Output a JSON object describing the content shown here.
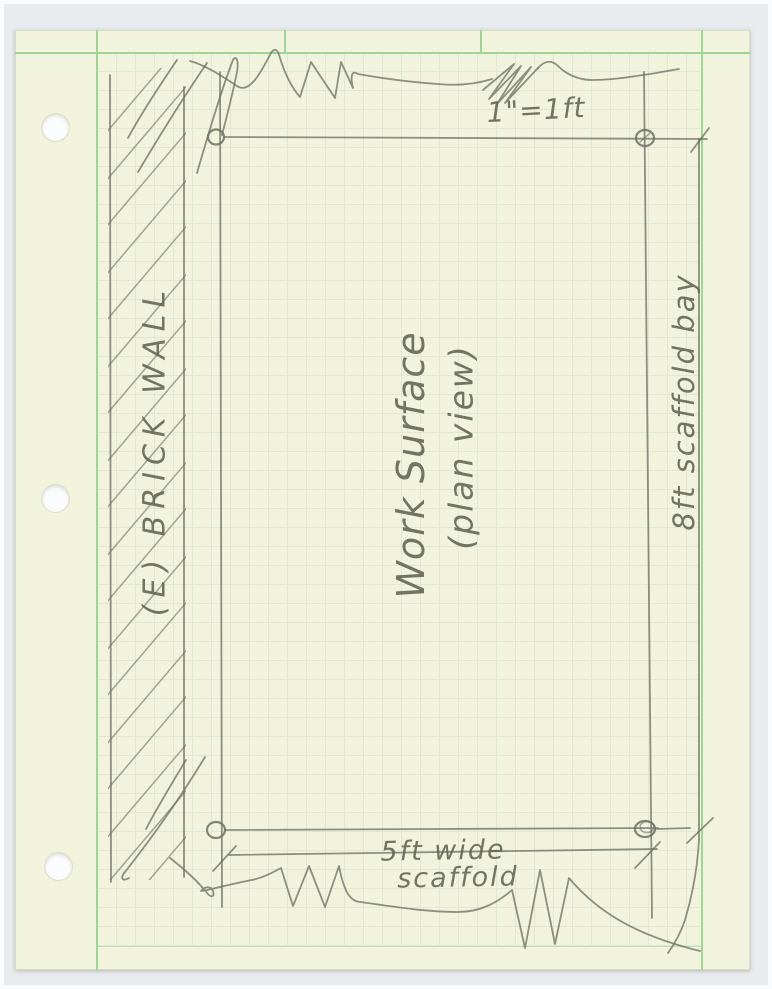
{
  "sketch": {
    "scale_note": "1\"=1ft",
    "wall_label": "(E) BRICK WALL",
    "surface_label_line1": "Work Surface",
    "surface_label_line2": "(plan view)",
    "bay_dimension_label": "8ft scaffold bay",
    "width_dimension_label_line1": "5ft wide",
    "width_dimension_label_line2": "scaffold"
  },
  "colors": {
    "paper": "#f1f3dc",
    "grid": "#cfe0cf",
    "margin": "#9fd595",
    "pencil": "#6e7263",
    "ink": "#5f6452",
    "background": "#e9ecef",
    "frame": "#fafbfc",
    "hole": "#fbfcfd"
  }
}
